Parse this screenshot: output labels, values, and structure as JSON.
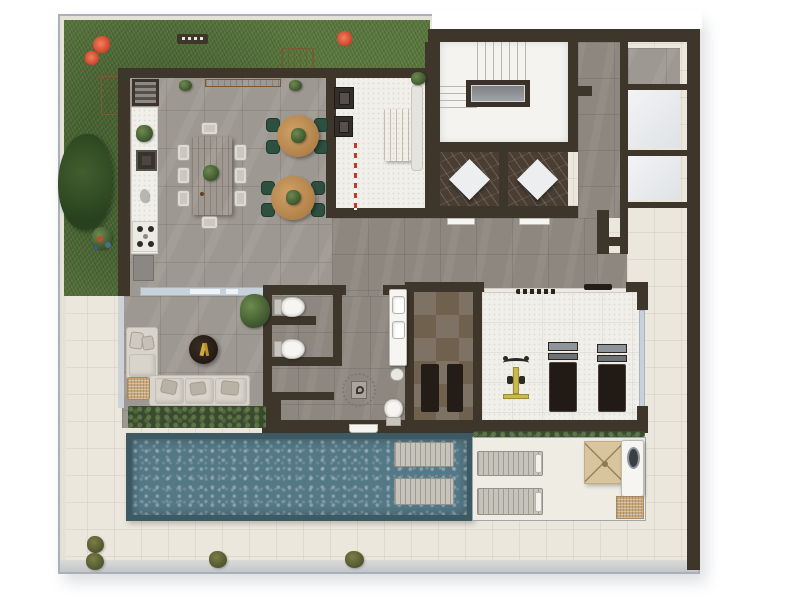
{
  "title": "rooftop-amenities-floor-plan",
  "palette": {
    "page_bg": "#ffffff",
    "parapet": "#aab0b8",
    "wall": "#3e352b",
    "grass": "#5c7940",
    "tile_gray": "#9e9892",
    "tile_taupe": "#8d8780",
    "tile_cream": "#ebe7dd",
    "tile_white": "#f0efe9",
    "marble": "#4a3e33",
    "pool_water": "#547886",
    "pool_border": "#3d5a64",
    "wood": "#bf8f55",
    "chair_green": "#2d5040",
    "sofa": "#d8d4cb",
    "cushion": "#b7b1a6",
    "glass": "#c6d1d9",
    "planter": "#3a4a31",
    "umbrella": "#d8c59e",
    "rattan": "#c8a97c",
    "accent_red": "#d84f35",
    "gym_yellow": "#c9ba4a",
    "equip_dark": "#241d17",
    "fixture_white": "#f6f5f1",
    "checker_a": "#70614f",
    "checker_b": "#7e7264",
    "lounger_slat": "#c6c3ba"
  },
  "rooms": [
    {
      "id": "garden"
    },
    {
      "id": "dining-room"
    },
    {
      "id": "bistro-area"
    },
    {
      "id": "kitchen"
    },
    {
      "id": "stair-hall"
    },
    {
      "id": "marble-cabins"
    },
    {
      "id": "corridor"
    },
    {
      "id": "restrooms"
    },
    {
      "id": "sauna"
    },
    {
      "id": "gym"
    },
    {
      "id": "lounge"
    },
    {
      "id": "pool"
    },
    {
      "id": "sun-deck"
    },
    {
      "id": "walkway"
    }
  ],
  "inventory": {
    "dining_chairs": 8,
    "bistro_tables": 2,
    "bistro_chairs_per_table": 4,
    "toilets": 3,
    "vanity_sinks": 2,
    "treadmills": 2,
    "exercise_bikes": 1,
    "in_pool_loungers": 2,
    "deck_loungers": 2,
    "umbrellas": 1,
    "garden_flowers": 3,
    "walkway_bushes": 4
  }
}
